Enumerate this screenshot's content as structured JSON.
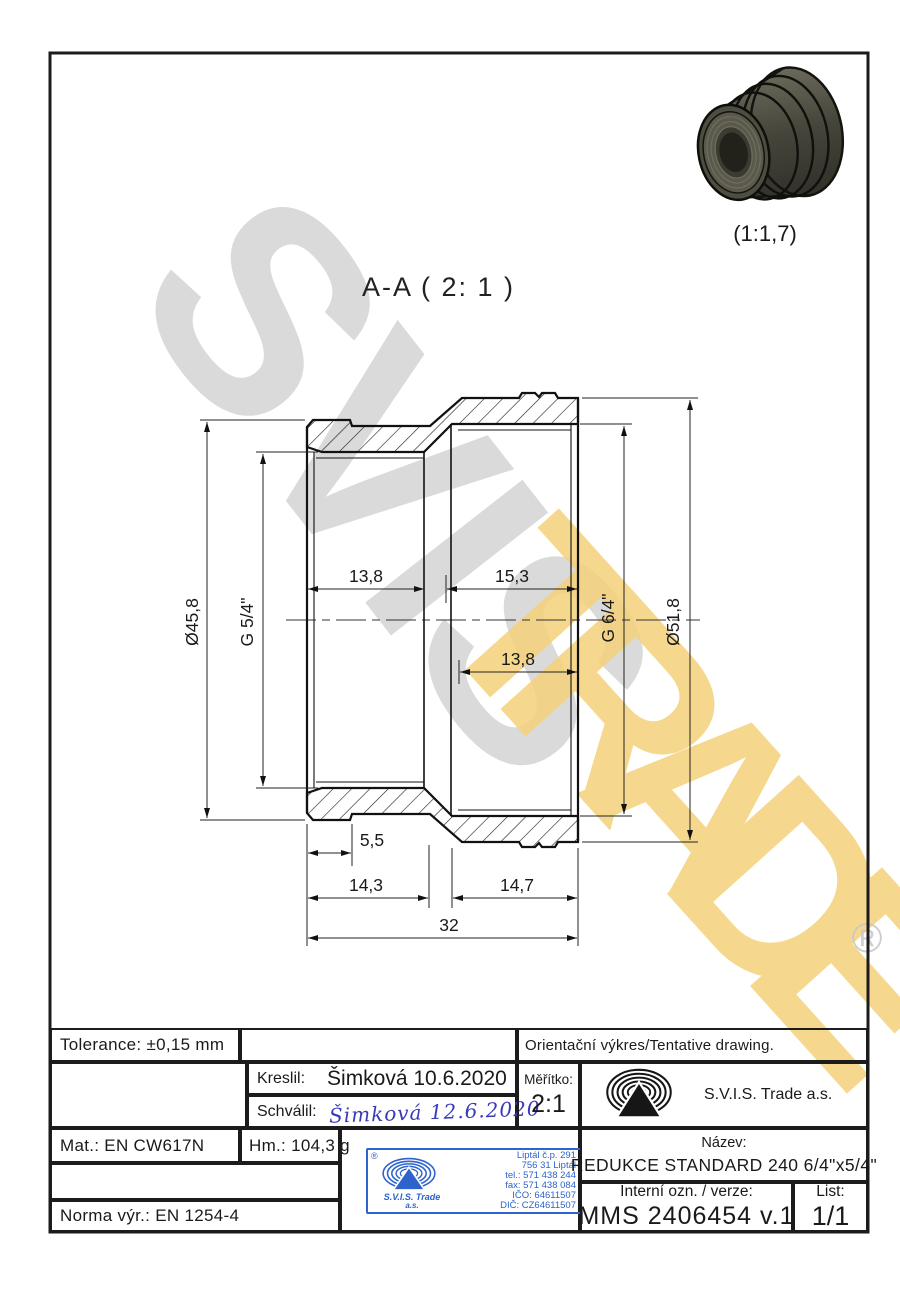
{
  "views": {
    "section_label": "A-A ( 2: 1 )",
    "render_scale": "(1:1,7)"
  },
  "watermark": {
    "word1": "SVIS",
    "word2": "TRADE",
    "registered": "®"
  },
  "dimensions": {
    "outer_dia_left": "Ø45,8",
    "thread_left": "G 5/4\"",
    "thread_right": "G 6/4\"",
    "outer_dia_right": "Ø51,8",
    "depth_left_top": "13,8",
    "depth_right_top": "15,3",
    "depth_right_mid": "13,8",
    "relief": "5,5",
    "len_left": "14,3",
    "len_right": "14,7",
    "total_len": "32"
  },
  "title_block": {
    "tolerance": "Tolerance: ±0,15 mm",
    "orientation_note": "Orientační výkres/Tentative drawing.",
    "kreslil_label": "Kreslil:",
    "kreslil_value": "Šimková 10.6.2020",
    "schvalil_label": "Schválil:",
    "schvalil_value": "Šimková 12.6.2020",
    "meritko_label": "Měřítko:",
    "meritko_value": "2:1",
    "company": "S.V.I.S. Trade a.s.",
    "mat": "Mat.: EN CW617N",
    "hm": "Hm.: 104,3 g",
    "norma": "Norma výr.: EN 1254-4",
    "nazev_label": "Název:",
    "nazev_value": "REDUKCE STANDARD 240 6/4\"x5/4\"",
    "interni_label": "Interní ozn. / verze:",
    "interni_value": "MMS 2406454 v.1",
    "list_label": "List:",
    "list_value": "1/1"
  },
  "stamp": {
    "registered": "®",
    "company1": "S.V.I.S. Trade",
    "company2": "a.s.",
    "address1": "Liptál č.p. 291",
    "address2": "756 31 Liptál",
    "tel": "tel.: 571 438 244",
    "fax": "fax: 571 438 084",
    "ico": "IČO: 64611507",
    "dic": "DIČ: CZ64611507"
  },
  "colors": {
    "line": "#1c1c1c",
    "watermark_gray": "#d2d2d2",
    "watermark_yellow": "#f4d27a",
    "stamp_blue": "#2d63cb",
    "signature_blue": "#3a3ab8"
  }
}
